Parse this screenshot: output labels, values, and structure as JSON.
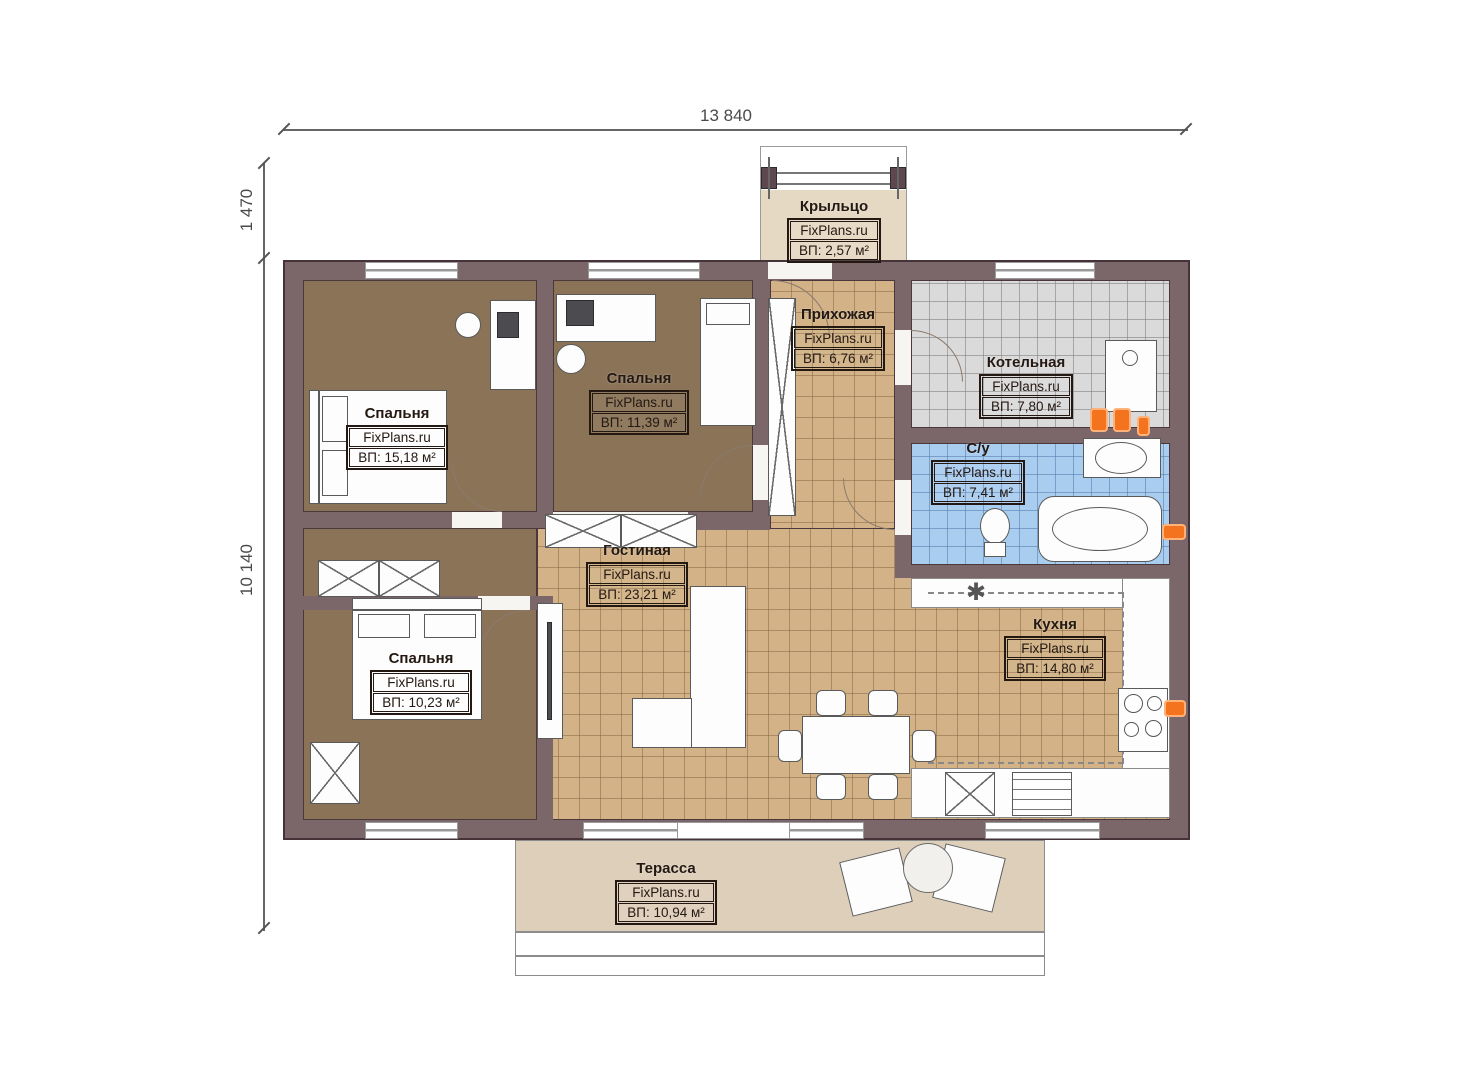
{
  "meta": {
    "brand": "FixPlans.ru",
    "area_unit": "м²"
  },
  "dimensions": {
    "top": "13 840",
    "left_upper": "1 470",
    "left_main": "10 140"
  },
  "rooms": [
    {
      "key": "porch",
      "name": "Крыльцо",
      "area": "ВП: 2,57 м²"
    },
    {
      "key": "hallway",
      "name": "Прихожая",
      "area": "ВП: 6,76 м²"
    },
    {
      "key": "boiler",
      "name": "Котельная",
      "area": "ВП: 7,80 м²"
    },
    {
      "key": "bathroom",
      "name": "С/у",
      "area": "ВП: 7,41 м²"
    },
    {
      "key": "bedroom1",
      "name": "Спальня",
      "area": "ВП: 15,18 м²"
    },
    {
      "key": "bedroom2",
      "name": "Спальня",
      "area": "ВП: 11,39 м²"
    },
    {
      "key": "bedroom3",
      "name": "Спальня",
      "area": "ВП: 10,23 м²"
    },
    {
      "key": "living",
      "name": "Гостиная",
      "area": "ВП: 23,21 м²"
    },
    {
      "key": "kitchen",
      "name": "Кухня",
      "area": "ВП: 14,80 м²"
    },
    {
      "key": "terrace",
      "name": "Терасса",
      "area": "ВП: 10,94 м²"
    }
  ],
  "symbols": {
    "freezer": "✱"
  },
  "colors": {
    "wall": "#7b666a",
    "wall_outline": "#463339",
    "bedroom_floor": "#8a7357",
    "tile_floor": "#d2b286",
    "boiler_floor": "#dadada",
    "bath_floor": "#a9cdee",
    "terrace_floor": "#ddcfba",
    "porch_floor": "#e6d9c4",
    "fixture_orange": "#f4731f",
    "dimension_grey": "#555555"
  }
}
